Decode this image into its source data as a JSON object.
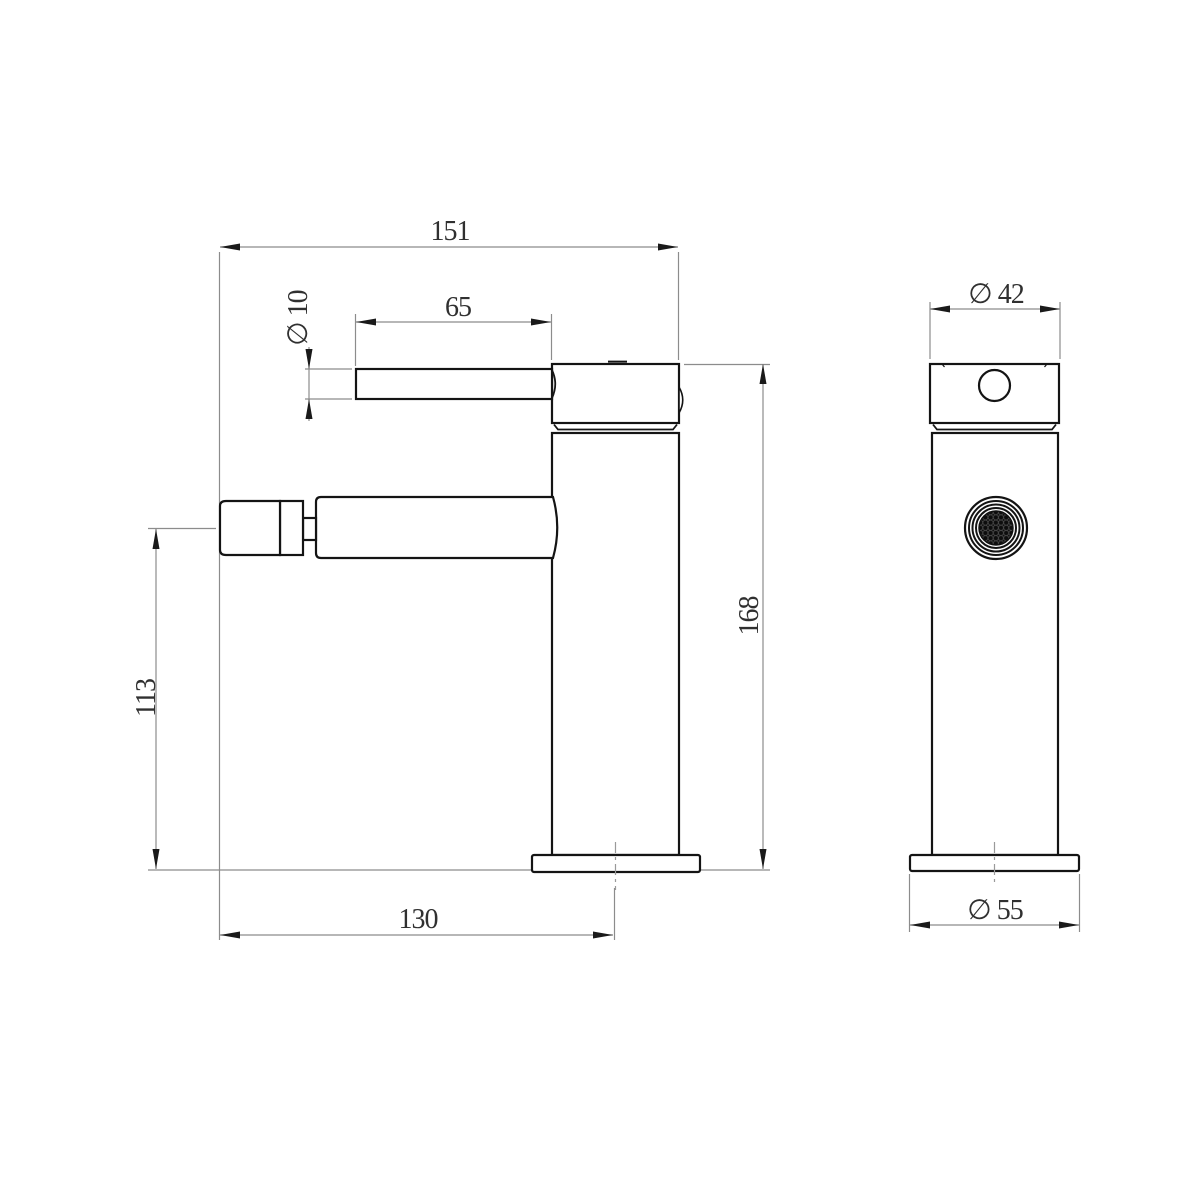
{
  "drawing": {
    "kind": "technical-orthographic-drawing",
    "subject": "single-lever bidet/basin mixer tap, side view and front view",
    "colors": {
      "object_line": "#141414",
      "dimension_line": "#8c8c8c",
      "center_line": "#9a9a9a",
      "text": "#303030",
      "background": "#ffffff"
    },
    "dimensions": {
      "overall_width": "151",
      "lever_length": "65",
      "lever_diameter": "∅ 10",
      "spout_height": "113",
      "total_height": "168",
      "spout_reach": "130",
      "body_diameter": "∅ 42",
      "base_diameter": "∅ 55"
    }
  }
}
